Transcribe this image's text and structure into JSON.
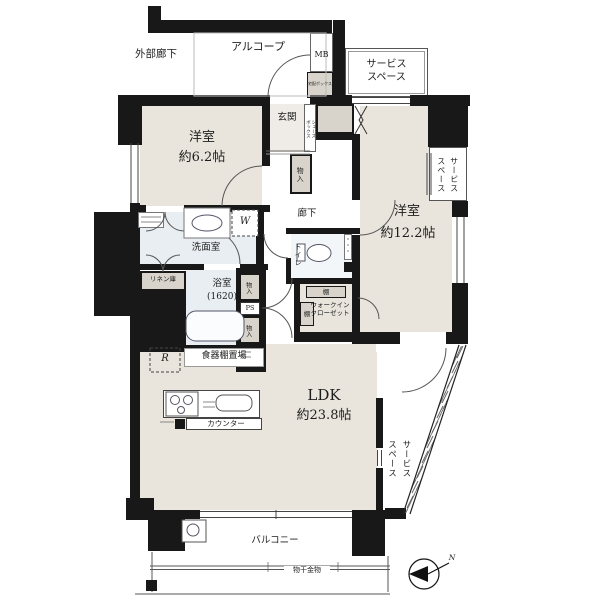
{
  "labels": {
    "exterior_corridor": "外部廊下",
    "alcove": "アルコープ",
    "mb": "MB",
    "delivery_box": "宅配ボックス",
    "service_space_top": "サービス\nスペース",
    "service_space_right": "サービス\nスペース",
    "service_space_bottom": "サービス\nスペース",
    "room1_name": "洋室",
    "room1_size": "約6.2帖",
    "genkan": "玄関",
    "shoes_box": "シューズ\nボックス",
    "hall_storage": "物入",
    "hallway": "廊下",
    "room2_name": "洋室",
    "room2_size": "約12.2帖",
    "washroom": "洗面室",
    "washer_mark": "W",
    "toilet": "トイレ",
    "linen": "リネン庫",
    "bath_name": "浴室",
    "bath_size": "(1620)",
    "storage_a": "物入",
    "ps": "PS",
    "storage_b": "物入",
    "shelf_top": "棚",
    "shelf_left": "棚",
    "wic": "ウォークイン\nクローゼット",
    "dish_shelf": "食器棚置場",
    "fridge_mark": "R",
    "counter": "カウンター",
    "ldk_name": "LDK",
    "ldk_size": "約23.8帖",
    "balcony": "バルコニー",
    "laundry_fitting": "物干金物",
    "compass_n": "N"
  },
  "colors": {
    "wall": "#181818",
    "room_beige": "#e9e4dc",
    "wet_blue": "#e9eef3",
    "storage_gray": "#d8d4cc"
  }
}
